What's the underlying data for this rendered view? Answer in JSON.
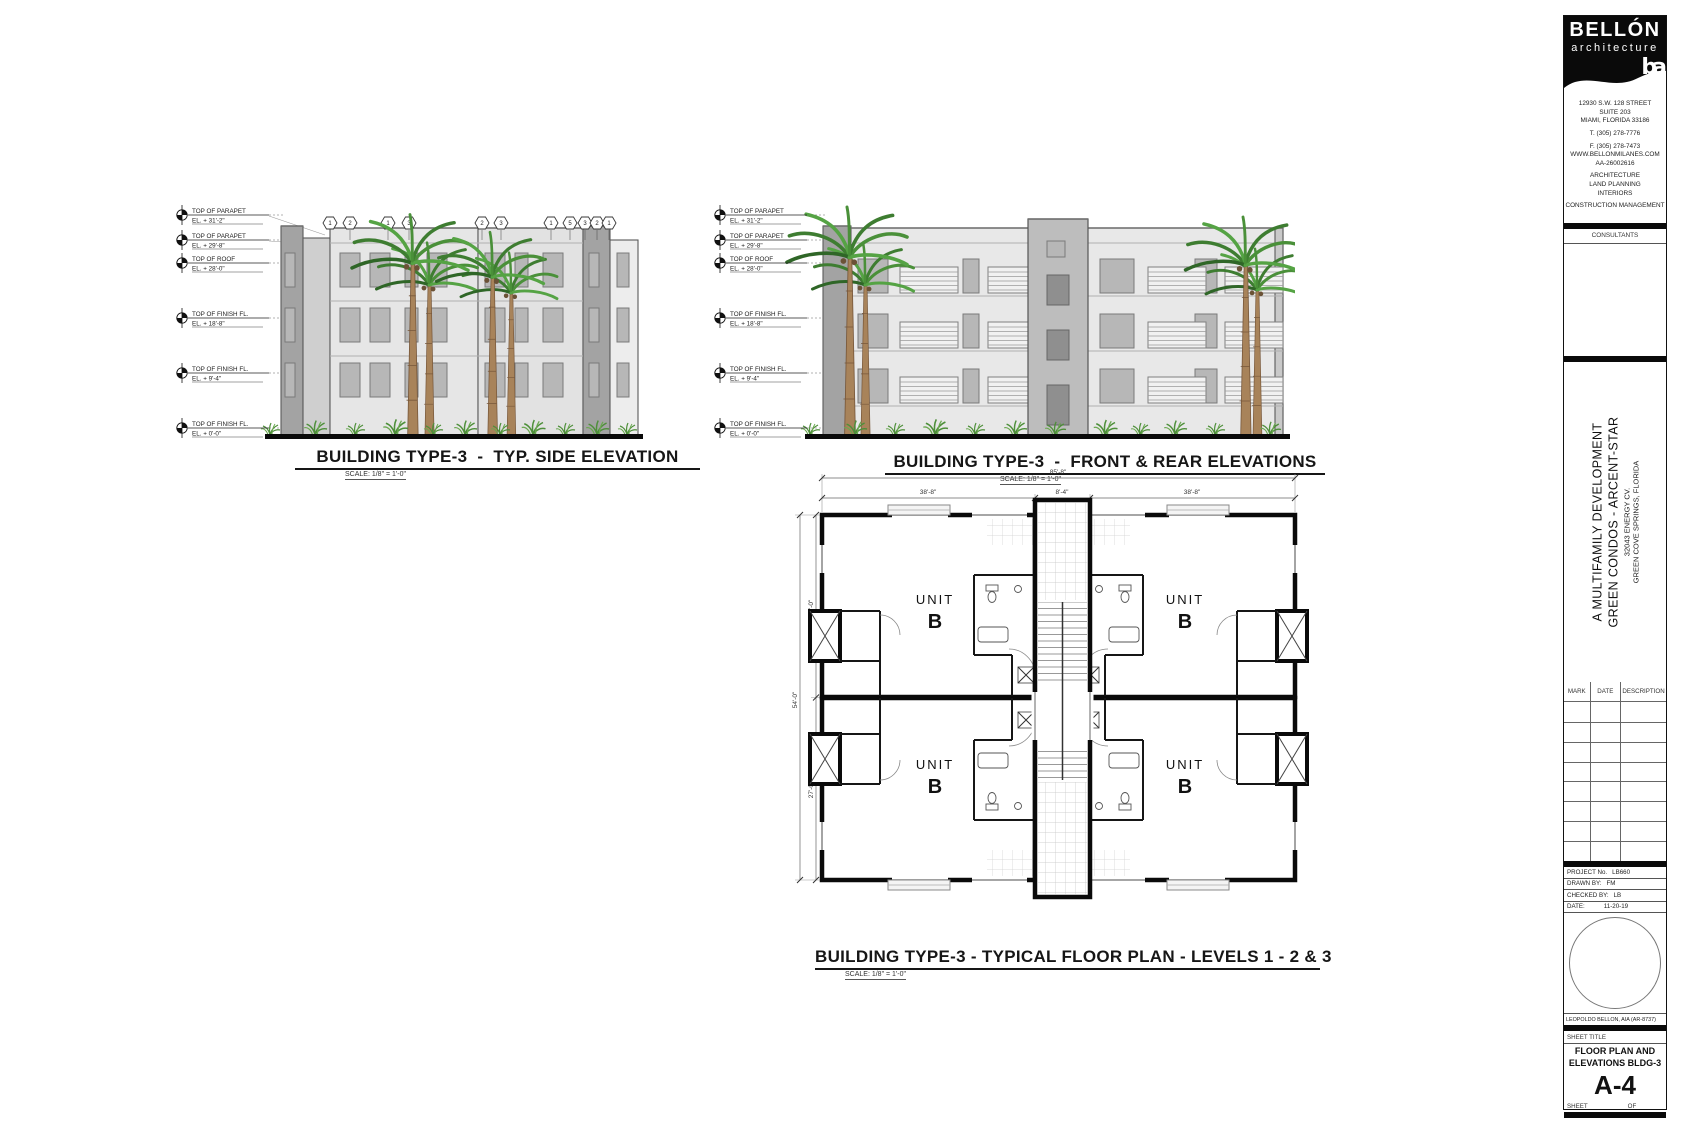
{
  "title_block": {
    "firm": {
      "name": "BELLÓN",
      "tagline": "architecture",
      "logo": "ba",
      "address": [
        "12930 S.W. 128 STREET",
        "SUITE 203",
        "MIAMI, FLORIDA  33186"
      ],
      "phone": "T. (305) 278-7776",
      "fax": "F. (305) 278-7473",
      "website": "WWW.BELLONMILANES.COM",
      "license": "AA-26002616",
      "services": [
        "ARCHITECTURE",
        "LAND PLANNING",
        "INTERIORS"
      ],
      "management": "CONSTRUCTION MANAGEMENT"
    },
    "consultants_label": "CONSULTANTS",
    "project_title": {
      "line1": "A MULTIFAMILY DEVELOPMENT",
      "line2": "GREEN CONDOS  -  ARCENT-STAR",
      "line3": "32043 ENERGY CV.",
      "line4": "GREEN COVE SPRINGS, FLORIDA"
    },
    "revision_headers": [
      "MARK",
      "DATE",
      "DESCRIPTION"
    ],
    "info_rows": [
      {
        "label": "PROJECT No.",
        "value": "LB660"
      },
      {
        "label": "DRAWN BY:",
        "value": "FM"
      },
      {
        "label": "CHECKED BY:",
        "value": "LB"
      },
      {
        "label": "DATE:",
        "value": "11-20-19"
      }
    ],
    "architect_line": "LEOPOLDO BELLON, AIA (AR-8737)",
    "sheet_title_label": "SHEET TITLE",
    "sheet_title_line1": "FLOOR PLAN AND",
    "sheet_title_line2": "ELEVATIONS BLDG-3",
    "sheet_number": "A-4",
    "sheet_label": "SHEET",
    "of_label": "OF"
  },
  "drawings": {
    "side_elevation": {
      "title": "BUILDING TYPE-3  -  TYP. SIDE ELEVATION",
      "scale": "SCALE: 1/8\" = 1'-0\"",
      "keynotes": [
        "1",
        "2",
        "1",
        "3",
        "2",
        "3",
        "1",
        "5",
        "3",
        "2",
        "1"
      ],
      "datums": [
        {
          "label": "TOP OF PARAPET",
          "elevation": "EL. + 31'-2\""
        },
        {
          "label": "TOP OF PARAPET",
          "elevation": "EL. + 29'-8\""
        },
        {
          "label": "TOP OF ROOF",
          "elevation": "EL. + 28'-0\""
        },
        {
          "label": "TOP OF FINISH FL.",
          "elevation": "EL. + 18'-8\""
        },
        {
          "label": "TOP OF FINISH FL.",
          "elevation": "EL. + 9'-4\""
        },
        {
          "label": "TOP OF FINISH FL.",
          "elevation": "EL. + 0'-0\""
        }
      ]
    },
    "front_elevation": {
      "title": "BUILDING TYPE-3  -  FRONT & REAR ELEVATIONS",
      "scale": "SCALE: 1/8\" = 1'-0\"",
      "datums": [
        {
          "label": "TOP OF PARAPET",
          "elevation": "EL. + 31'-2\""
        },
        {
          "label": "TOP OF PARAPET",
          "elevation": "EL. + 29'-8\""
        },
        {
          "label": "TOP OF ROOF",
          "elevation": "EL. + 28'-0\""
        },
        {
          "label": "TOP OF FINISH FL.",
          "elevation": "EL. + 18'-8\""
        },
        {
          "label": "TOP OF FINISH FL.",
          "elevation": "EL. + 9'-4\""
        },
        {
          "label": "TOP OF FINISH FL.",
          "elevation": "EL. + 0'-0\""
        }
      ]
    },
    "floor_plan": {
      "title": "BUILDING TYPE-3 - TYPICAL FLOOR PLAN - LEVELS 1 - 2 & 3",
      "scale": "SCALE: 1/8\" = 1'-0\"",
      "dimensions": {
        "top_total": "85'-8\"",
        "top_left": "38'-8\"",
        "top_center": "8'-4\"",
        "top_right": "38'-8\"",
        "side_total": "54'-0\"",
        "side_upper": "27'-0\"",
        "side_lower": "27'-0\""
      },
      "units": [
        {
          "name": "UNIT",
          "letter": "B"
        },
        {
          "name": "UNIT",
          "letter": "B"
        },
        {
          "name": "UNIT",
          "letter": "B"
        },
        {
          "name": "UNIT",
          "letter": "B"
        }
      ]
    }
  }
}
